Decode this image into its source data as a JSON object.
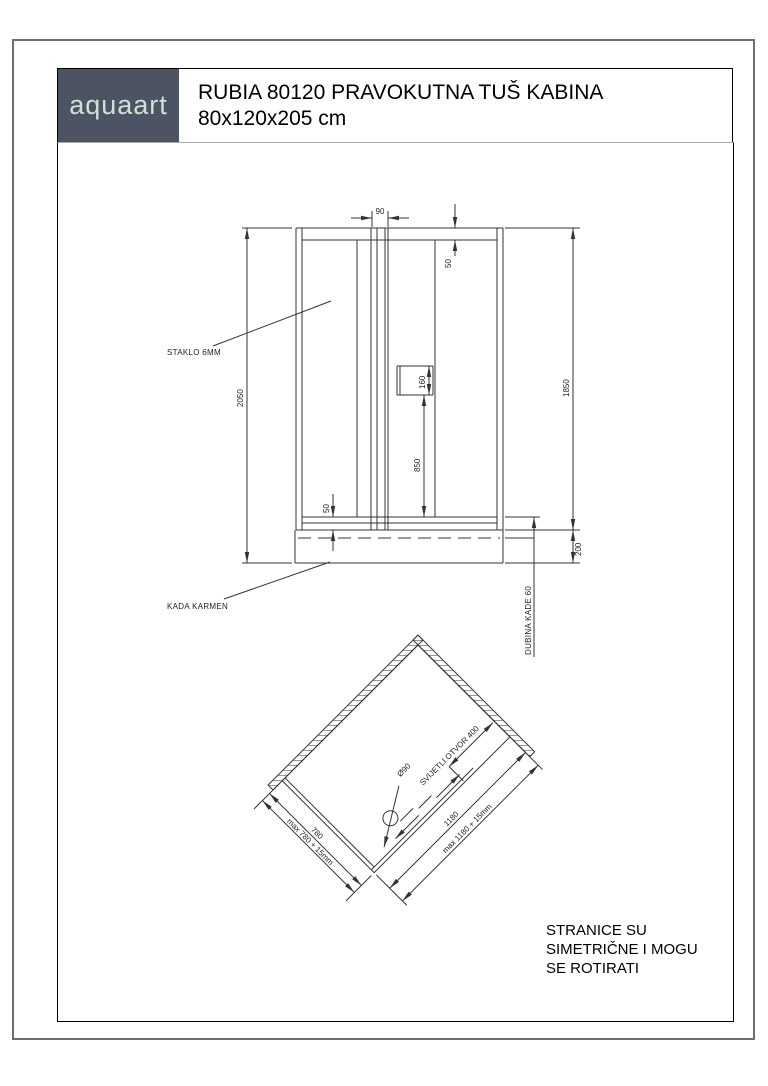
{
  "header": {
    "logo": "aquaart",
    "title_line1": "RUBIA 80120 PRAVOKUTNA TUŠ KABINA",
    "title_line2": "80x120x205 cm"
  },
  "elevation": {
    "dim_90": "90",
    "dim_50_top": "50",
    "dim_2050": "2050",
    "dim_1850": "1850",
    "dim_160": "160",
    "dim_850": "850",
    "dim_50_bottom": "50",
    "dim_200": "200",
    "label_staklo": "STAKLO 6MM",
    "label_kada": "KADA KARMEN",
    "label_dubina": "DUBINA KADE 60"
  },
  "plan": {
    "dim_780": "780",
    "dim_780_max": "max 780 + 15mm",
    "dim_1180": "1180",
    "dim_1180_max": "max 1180 + 15mm",
    "dim_otvor": "SVIJETLI OTVOR 400",
    "dim_drain": "Ø90"
  },
  "note": {
    "line1": "STRANICE SU",
    "line2": "SIMETRIČNE I MOGU",
    "line3": "SE ROTIRATI"
  },
  "colors": {
    "logo_bg": "#4c5464",
    "logo_text": "#cfe0d6",
    "line": "#333333",
    "page_border": "#6e6e6e"
  }
}
